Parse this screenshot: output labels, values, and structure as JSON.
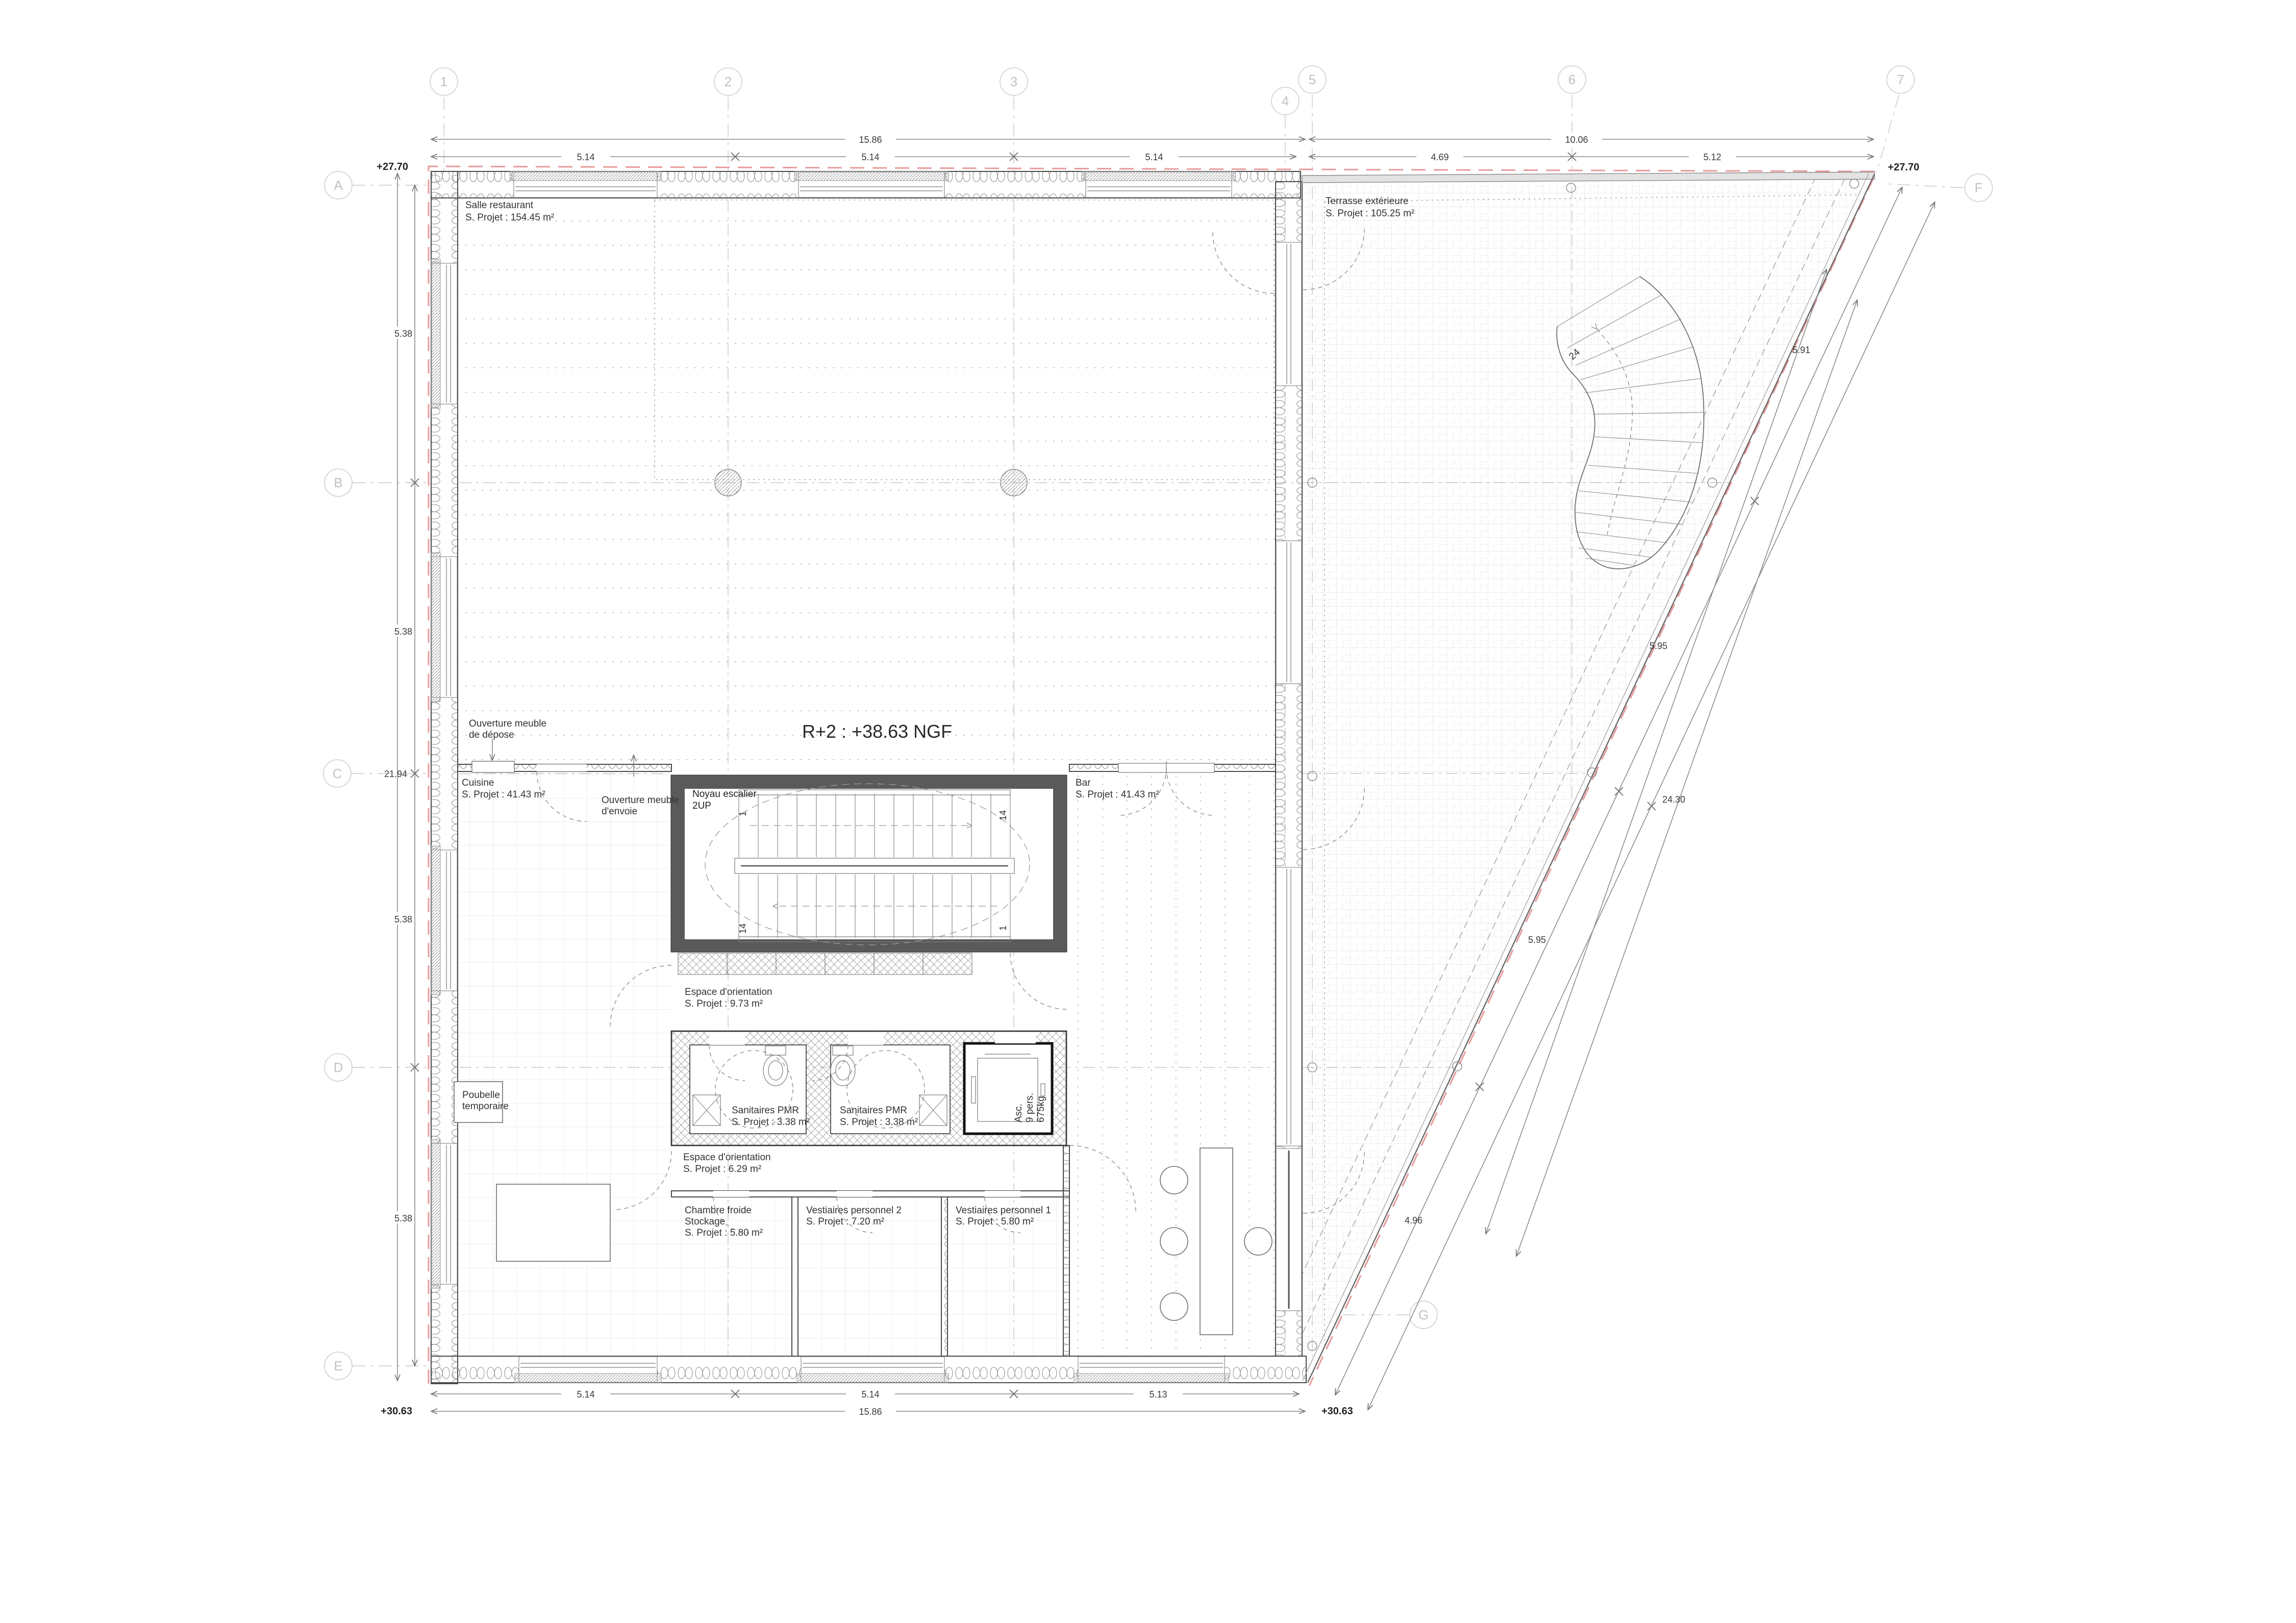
{
  "title": "R+2 : +38.63 NGF",
  "grid": {
    "cols": [
      "1",
      "2",
      "3",
      "4",
      "5",
      "6",
      "7"
    ],
    "rows": [
      "A",
      "B",
      "C",
      "D",
      "E"
    ],
    "other": {
      "f": "F",
      "g": "G"
    }
  },
  "levels": {
    "top_left": "+27.70",
    "top_right": "+27.70",
    "bottom_left": "+30.63",
    "bottom_right": "+30.63"
  },
  "dims": {
    "top": {
      "overall": "15.86",
      "segs": [
        "5.14",
        "5.14",
        "5.14"
      ]
    },
    "top_right": {
      "overall": "10.06",
      "segs": [
        "4.69",
        "5.12"
      ]
    },
    "bottom": {
      "overall": "15.86",
      "segs": [
        "5.14",
        "5.14",
        "5.13"
      ]
    },
    "left": {
      "overall": "21.94",
      "segs": [
        "5.38",
        "5.38",
        "5.38",
        "5.38"
      ]
    },
    "slope": {
      "overall": "24.30",
      "segs": [
        "5.91",
        "5.95",
        "5.95",
        "4.96"
      ]
    }
  },
  "rooms": {
    "salle": {
      "name": "Salle restaurant",
      "area": "S. Projet : 154.45 m²"
    },
    "terrasse": {
      "name": "Terrasse extérieure",
      "area": "S. Projet : 105.25 m²"
    },
    "cuisine": {
      "name": "Cuisine",
      "area": "S. Projet : 41.43 m²"
    },
    "bar": {
      "name": "Bar",
      "area": "S. Projet : 41.43 m²"
    },
    "noyau": {
      "name": "Noyau escalier",
      "sub": "2UP"
    },
    "espace1": {
      "name": "Espace d'orientation",
      "area": "S. Projet : 9.73 m²"
    },
    "san1": {
      "name": "Sanitaires PMR",
      "area": "S. Projet : 3.38 m²"
    },
    "san2": {
      "name": "Sanitaires PMR",
      "area": "S. Projet : 3.38 m²"
    },
    "asc": {
      "l1": "Asc.",
      "l2": "9 pers.",
      "l3": "675kg"
    },
    "espace2": {
      "name": "Espace d'orientation",
      "area": "S. Projet : 6.29 m²"
    },
    "poubelle": {
      "l1": "Poubelle",
      "l2": "temporaire"
    },
    "chambre": {
      "l1": "Chambre froide",
      "l2": "Stockage",
      "area": "S. Projet : 5.80 m²"
    },
    "vest2": {
      "name": "Vestiaires personnel 2",
      "area": "S. Projet : 7.20 m²"
    },
    "vest1": {
      "name": "Vestiaires personnel 1",
      "area": "S. Projet : 5.80 m²"
    }
  },
  "annotations": {
    "depose": {
      "l1": "Ouverture meuble",
      "l2": "de dépose"
    },
    "envoie": {
      "l1": "Ouverture meuble",
      "l2": "d'envoie"
    }
  },
  "stair": {
    "m1": "1",
    "m2": "14",
    "m3": "14",
    "m4": "1",
    "spiral": "24"
  }
}
